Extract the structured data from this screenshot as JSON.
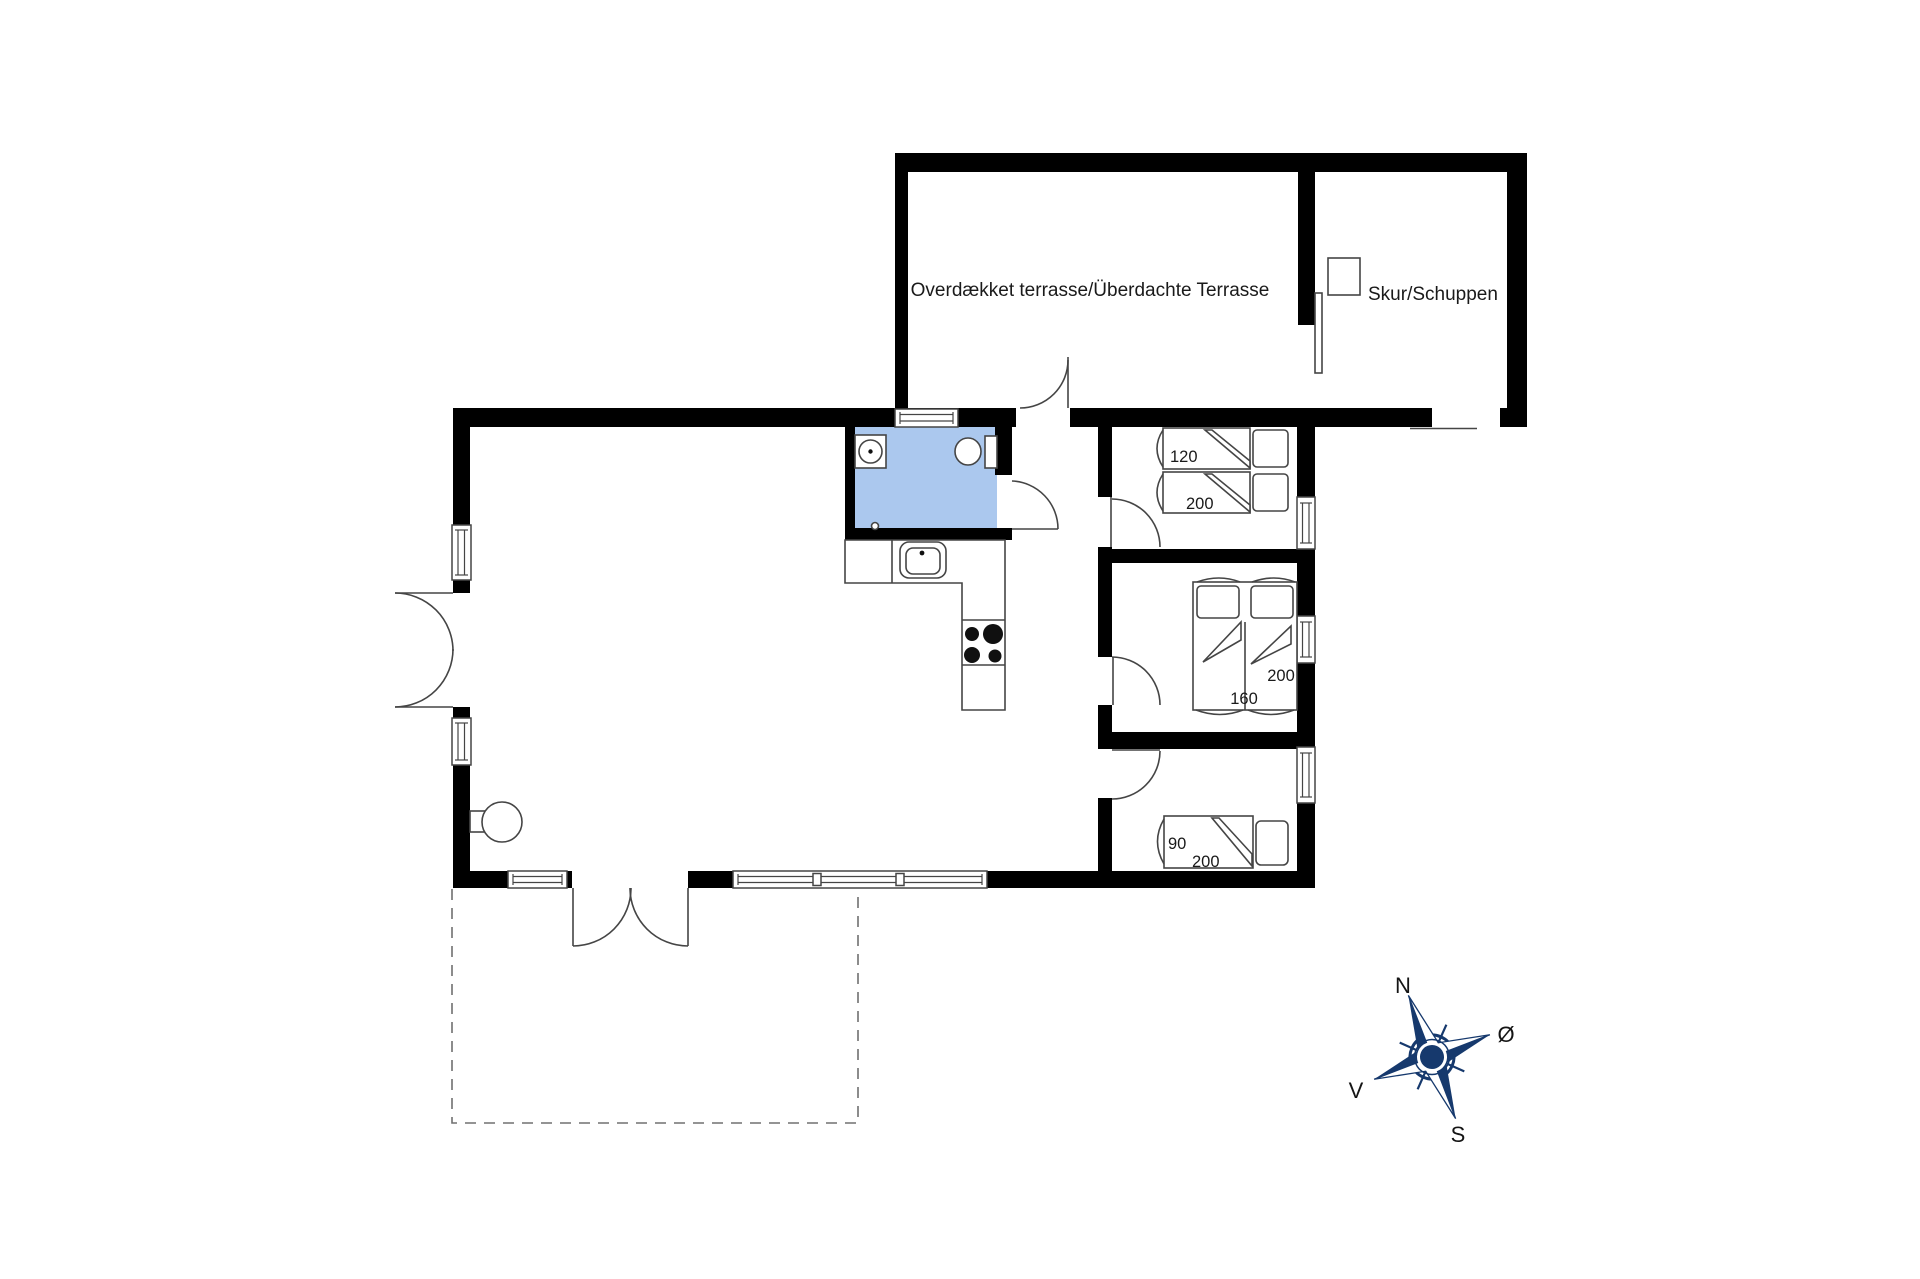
{
  "document": {
    "type": "floor-plan",
    "background": "#ffffff"
  },
  "labels": {
    "covered_terrace": "Overdækket terrasse/Überdachte Terrasse",
    "shed": "Skur/Schuppen"
  },
  "rooms": {
    "bedroom_top": {
      "bed_width_cm": "120",
      "bed_length_cm": "200"
    },
    "bedroom_middle": {
      "bed_width_cm": "160",
      "bed_length_cm": "200"
    },
    "bedroom_bottom": {
      "bed_width_cm": "90",
      "bed_length_cm": "200"
    }
  },
  "compass": {
    "north": "N",
    "east": "Ø",
    "south": "S",
    "west": "V"
  },
  "colors": {
    "wall": "#000000",
    "bathroom": "#abc8ee",
    "compass": "#16396d",
    "line": "#454545",
    "dash": "#707070",
    "text": "#1a1a1a"
  }
}
